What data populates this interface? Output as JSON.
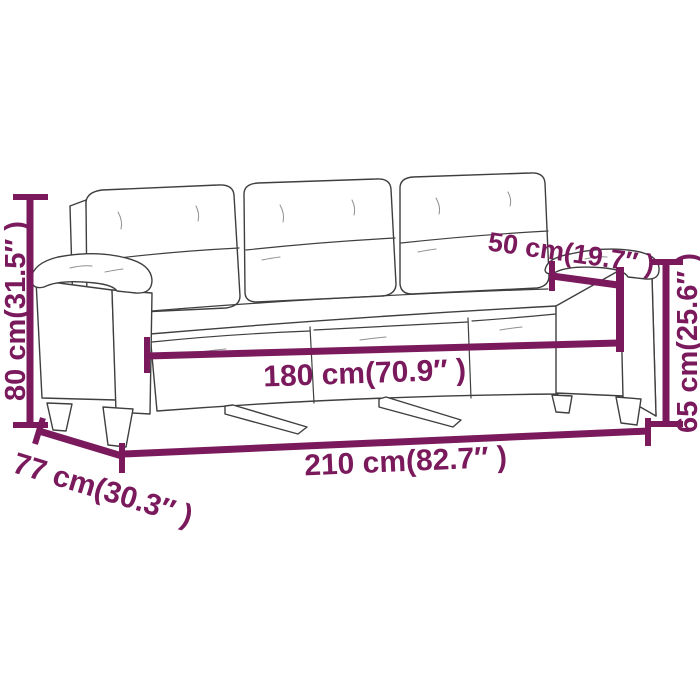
{
  "meta": {
    "description": "Line-art dimension diagram of a 3-seater sofa with six measurement callouts",
    "background": "#ffffff"
  },
  "colors": {
    "dimension_annotation": "#7a1a5c",
    "art_outline": "#3f3f3f"
  },
  "dimensions": {
    "total_height": {
      "label": "80 cm(31.5″ )",
      "value_cm": 80,
      "value_in": 31.5
    },
    "armrest_depth": {
      "label": "50 cm(19.7″ )",
      "value_cm": 50,
      "value_in": 19.7
    },
    "armrest_height": {
      "label": "65 cm(25.6″ )",
      "value_cm": 65,
      "value_in": 25.6
    },
    "seat_width": {
      "label": "180 cm(70.9″ )",
      "value_cm": 180,
      "value_in": 70.9
    },
    "total_width": {
      "label": "210 cm(82.7″ )",
      "value_cm": 210,
      "value_in": 82.7
    },
    "total_depth": {
      "label": "77 cm(30.3″ )",
      "value_cm": 77,
      "value_in": 30.3
    }
  }
}
